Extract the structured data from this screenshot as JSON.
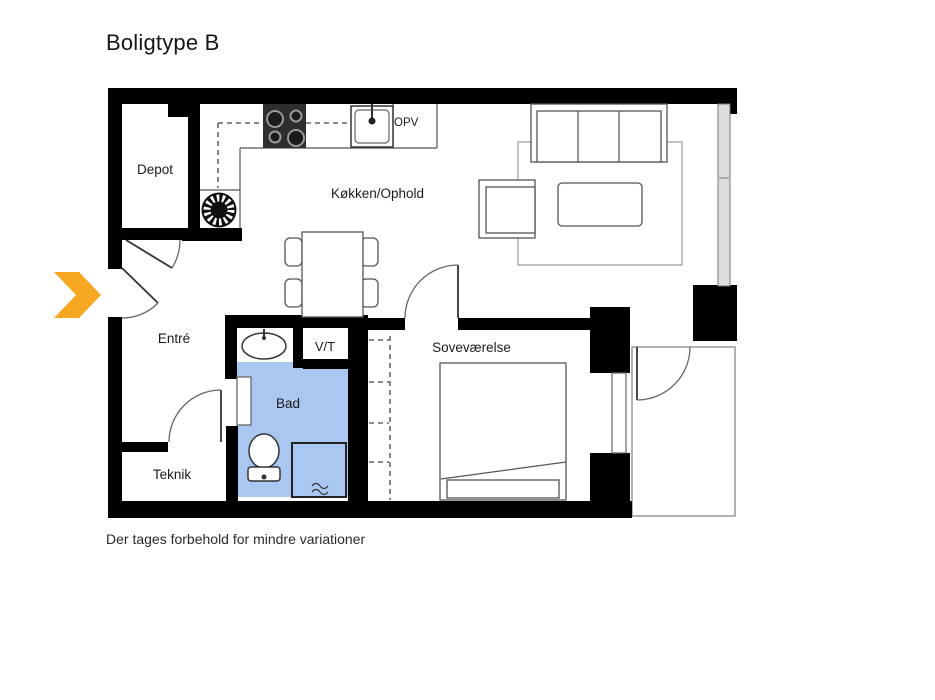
{
  "title": "Boligtype B",
  "disclaimer": "Der tages forbehold for mindre variationer",
  "rooms": {
    "depot": "Depot",
    "kitchen_living": "Køkken/Ophold",
    "entry": "Entré",
    "bath": "Bad",
    "washer_dryer": "V/T",
    "bedroom": "Soveværelse",
    "utility": "Teknik",
    "dishwasher": "OPV"
  },
  "colors": {
    "wall": "#000000",
    "bath-fill": "#a9c7f0",
    "accent-arrow": "#f7a722",
    "furniture-line": "#555555",
    "terrace-line": "#999999"
  }
}
